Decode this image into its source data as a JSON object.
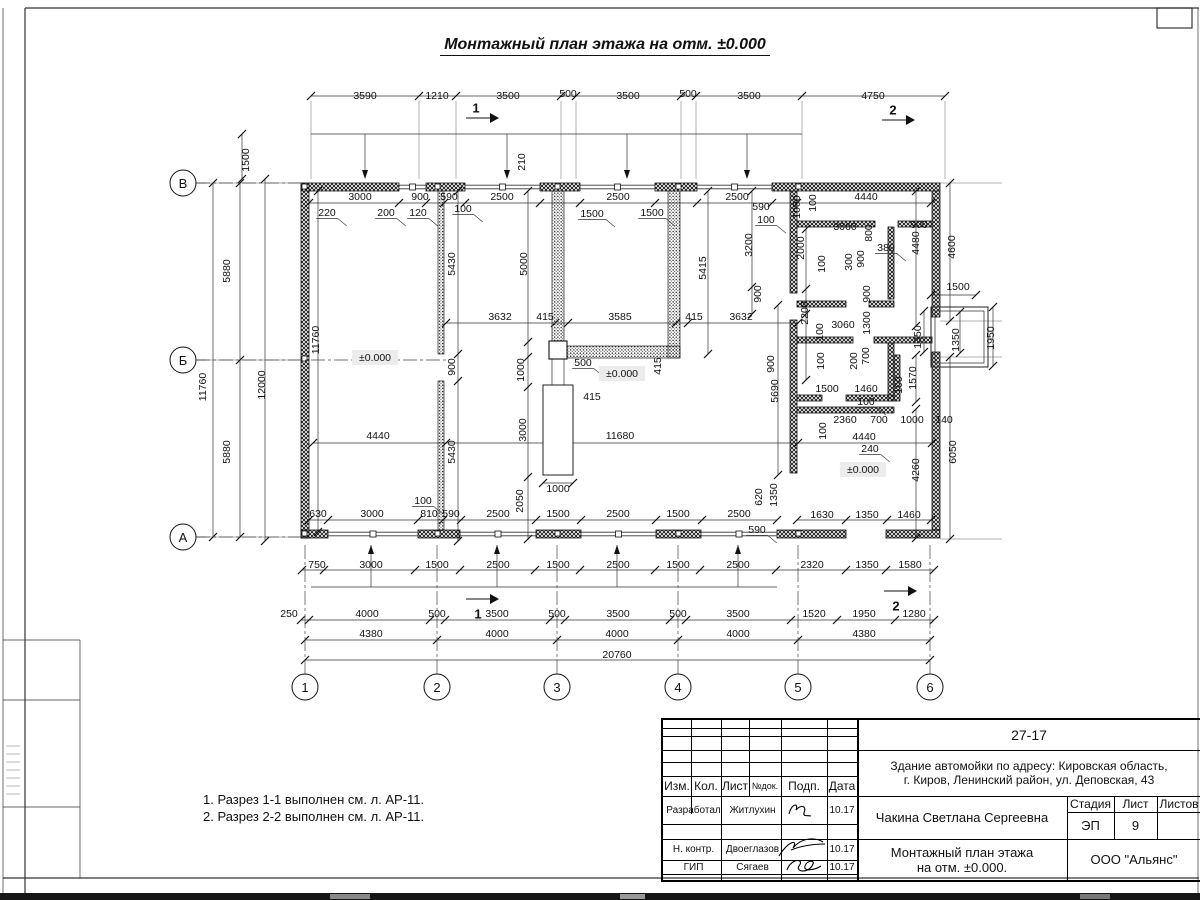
{
  "sheet": {
    "main_title": "Монтажный план этажа на отм. ±0.000",
    "notes": [
      "1. Разрез 1-1 выполнен см. л. АР-11.",
      "2. Разрез 2-2 выполнен см. л. АР-11."
    ]
  },
  "axes": {
    "rows": [
      "В",
      "Б",
      "А"
    ],
    "cols": [
      "1",
      "2",
      "3",
      "4",
      "5",
      "6"
    ]
  },
  "section_marks": {
    "top1": "1",
    "top2": "2",
    "bottom1": "1",
    "bottom2": "2"
  },
  "elevation_mark": "±0.000",
  "dim_labels": [
    {
      "t": "3590",
      "x": 365,
      "y": 96
    },
    {
      "t": "1210",
      "x": 437,
      "y": 96
    },
    {
      "t": "3500",
      "x": 508,
      "y": 96
    },
    {
      "t": "500",
      "x": 568,
      "y": 94
    },
    {
      "t": "3500",
      "x": 628,
      "y": 96
    },
    {
      "t": "500",
      "x": 688,
      "y": 94
    },
    {
      "t": "3500",
      "x": 749,
      "y": 96
    },
    {
      "t": "4750",
      "x": 873,
      "y": 96
    },
    {
      "t": "1500",
      "x": 246,
      "y": 160,
      "f": "r"
    },
    {
      "t": "210",
      "x": 522,
      "y": 162,
      "f": "r"
    },
    {
      "t": "3000",
      "x": 360,
      "y": 197
    },
    {
      "t": "900",
      "x": 420,
      "y": 197
    },
    {
      "t": "590",
      "x": 449,
      "y": 197
    },
    {
      "t": "2500",
      "x": 502,
      "y": 197
    },
    {
      "t": "2500",
      "x": 618,
      "y": 197
    },
    {
      "t": "2500",
      "x": 737,
      "y": 197
    },
    {
      "t": "4440",
      "x": 866,
      "y": 197
    },
    {
      "t": "590",
      "x": 761,
      "y": 207
    },
    {
      "t": "100",
      "x": 766,
      "y": 220,
      "f": "u"
    },
    {
      "t": "220",
      "x": 327,
      "y": 213,
      "f": "u"
    },
    {
      "t": "200",
      "x": 386,
      "y": 213,
      "f": "u"
    },
    {
      "t": "120",
      "x": 418,
      "y": 213,
      "f": "u"
    },
    {
      "t": "100",
      "x": 463,
      "y": 209,
      "f": "u"
    },
    {
      "t": "1500",
      "x": 592,
      "y": 214,
      "f": "u"
    },
    {
      "t": "1500",
      "x": 652,
      "y": 213,
      "f": "u"
    },
    {
      "t": "1000",
      "x": 797,
      "y": 207,
      "f": "r"
    },
    {
      "t": "100",
      "x": 813,
      "y": 203,
      "f": "r"
    },
    {
      "t": "5880",
      "x": 227,
      "y": 271,
      "f": "r"
    },
    {
      "t": "11760",
      "x": 203,
      "y": 387,
      "f": "r"
    },
    {
      "t": "12000",
      "x": 262,
      "y": 385,
      "f": "r"
    },
    {
      "t": "5880",
      "x": 227,
      "y": 452,
      "f": "r"
    },
    {
      "t": "11760",
      "x": 316,
      "y": 340,
      "f": "r"
    },
    {
      "t": "5430",
      "x": 452,
      "y": 264,
      "f": "r"
    },
    {
      "t": "5000",
      "x": 524,
      "y": 264,
      "f": "r"
    },
    {
      "t": "5415",
      "x": 703,
      "y": 268,
      "f": "r"
    },
    {
      "t": "900",
      "x": 452,
      "y": 367,
      "f": "r"
    },
    {
      "t": "5430",
      "x": 452,
      "y": 452,
      "f": "r"
    },
    {
      "t": "3632",
      "x": 500,
      "y": 317
    },
    {
      "t": "415",
      "x": 545,
      "y": 317
    },
    {
      "t": "3585",
      "x": 620,
      "y": 317
    },
    {
      "t": "415",
      "x": 694,
      "y": 317
    },
    {
      "t": "3632",
      "x": 741,
      "y": 317
    },
    {
      "t": "500",
      "x": 583,
      "y": 363,
      "f": "u"
    },
    {
      "t": "415",
      "x": 592,
      "y": 397
    },
    {
      "t": "415",
      "x": 658,
      "y": 366,
      "f": "r"
    },
    {
      "t": "1000",
      "x": 521,
      "y": 370,
      "f": "r"
    },
    {
      "t": "3000",
      "x": 523,
      "y": 430,
      "f": "r"
    },
    {
      "t": "2050",
      "x": 520,
      "y": 501,
      "f": "r"
    },
    {
      "t": "1000",
      "x": 558,
      "y": 489
    },
    {
      "t": "4440",
      "x": 378,
      "y": 436
    },
    {
      "t": "11680",
      "x": 620,
      "y": 436
    },
    {
      "t": "±0.000",
      "x": 375,
      "y": 358,
      "f": "b"
    },
    {
      "t": "±0.000",
      "x": 622,
      "y": 374,
      "f": "b"
    },
    {
      "t": "±0.000",
      "x": 863,
      "y": 470,
      "f": "b"
    },
    {
      "t": "4600",
      "x": 952,
      "y": 247,
      "f": "r"
    },
    {
      "t": "4480",
      "x": 916,
      "y": 243,
      "f": "r"
    },
    {
      "t": "900",
      "x": 919,
      "y": 225
    },
    {
      "t": "3060",
      "x": 845,
      "y": 227
    },
    {
      "t": "800",
      "x": 869,
      "y": 233,
      "f": "r"
    },
    {
      "t": "380",
      "x": 886,
      "y": 248,
      "f": "u"
    },
    {
      "t": "2000",
      "x": 801,
      "y": 248,
      "f": "r"
    },
    {
      "t": "300",
      "x": 849,
      "y": 262,
      "f": "r"
    },
    {
      "t": "900",
      "x": 861,
      "y": 259,
      "f": "r"
    },
    {
      "t": "100",
      "x": 822,
      "y": 264,
      "f": "r"
    },
    {
      "t": "3200",
      "x": 749,
      "y": 245,
      "f": "r"
    },
    {
      "t": "900",
      "x": 758,
      "y": 294,
      "f": "r"
    },
    {
      "t": "2200",
      "x": 805,
      "y": 313,
      "f": "r"
    },
    {
      "t": "900",
      "x": 867,
      "y": 294,
      "f": "r"
    },
    {
      "t": "3060",
      "x": 843,
      "y": 325
    },
    {
      "t": "1300",
      "x": 867,
      "y": 323,
      "f": "r"
    },
    {
      "t": "100",
      "x": 820,
      "y": 332,
      "f": "r"
    },
    {
      "t": "1500",
      "x": 958,
      "y": 287
    },
    {
      "t": "1350",
      "x": 918,
      "y": 337,
      "f": "r"
    },
    {
      "t": "1350",
      "x": 956,
      "y": 340,
      "f": "r"
    },
    {
      "t": "1950",
      "x": 991,
      "y": 338,
      "f": "r"
    },
    {
      "t": "5690",
      "x": 775,
      "y": 391,
      "f": "r"
    },
    {
      "t": "900",
      "x": 771,
      "y": 364,
      "f": "r"
    },
    {
      "t": "100",
      "x": 821,
      "y": 361,
      "f": "r"
    },
    {
      "t": "200",
      "x": 854,
      "y": 361,
      "f": "r"
    },
    {
      "t": "700",
      "x": 866,
      "y": 356,
      "f": "r"
    },
    {
      "t": "1500",
      "x": 827,
      "y": 389
    },
    {
      "t": "1460",
      "x": 866,
      "y": 389
    },
    {
      "t": "100",
      "x": 866,
      "y": 402,
      "f": "u"
    },
    {
      "t": "100",
      "x": 899,
      "y": 385,
      "f": "r"
    },
    {
      "t": "1570",
      "x": 913,
      "y": 378,
      "f": "r"
    },
    {
      "t": "2360",
      "x": 845,
      "y": 420
    },
    {
      "t": "700",
      "x": 879,
      "y": 420
    },
    {
      "t": "1000",
      "x": 912,
      "y": 420
    },
    {
      "t": "140",
      "x": 944,
      "y": 420
    },
    {
      "t": "100",
      "x": 823,
      "y": 431,
      "f": "r"
    },
    {
      "t": "4440",
      "x": 864,
      "y": 437
    },
    {
      "t": "240",
      "x": 870,
      "y": 449,
      "f": "u"
    },
    {
      "t": "4260",
      "x": 916,
      "y": 470,
      "f": "r"
    },
    {
      "t": "6050",
      "x": 953,
      "y": 452,
      "f": "r"
    },
    {
      "t": "630",
      "x": 318,
      "y": 514
    },
    {
      "t": "3000",
      "x": 372,
      "y": 514
    },
    {
      "t": "100",
      "x": 423,
      "y": 501,
      "f": "u"
    },
    {
      "t": "810",
      "x": 429,
      "y": 514
    },
    {
      "t": "590",
      "x": 451,
      "y": 514
    },
    {
      "t": "2500",
      "x": 498,
      "y": 514
    },
    {
      "t": "1500",
      "x": 558,
      "y": 514
    },
    {
      "t": "2500",
      "x": 618,
      "y": 514
    },
    {
      "t": "1500",
      "x": 678,
      "y": 514
    },
    {
      "t": "2500",
      "x": 739,
      "y": 514
    },
    {
      "t": "620",
      "x": 759,
      "y": 497,
      "f": "r"
    },
    {
      "t": "1350",
      "x": 774,
      "y": 495,
      "f": "r"
    },
    {
      "t": "590",
      "x": 757,
      "y": 530,
      "f": "u"
    },
    {
      "t": "1630",
      "x": 822,
      "y": 515
    },
    {
      "t": "1350",
      "x": 867,
      "y": 515
    },
    {
      "t": "1460",
      "x": 909,
      "y": 515
    },
    {
      "t": "750",
      "x": 317,
      "y": 565
    },
    {
      "t": "3000",
      "x": 371,
      "y": 565
    },
    {
      "t": "1500",
      "x": 437,
      "y": 565
    },
    {
      "t": "2500",
      "x": 498,
      "y": 565
    },
    {
      "t": "1500",
      "x": 558,
      "y": 565
    },
    {
      "t": "2500",
      "x": 618,
      "y": 565
    },
    {
      "t": "1500",
      "x": 678,
      "y": 565
    },
    {
      "t": "2500",
      "x": 738,
      "y": 565
    },
    {
      "t": "2320",
      "x": 812,
      "y": 565
    },
    {
      "t": "1350",
      "x": 867,
      "y": 565
    },
    {
      "t": "1580",
      "x": 910,
      "y": 565
    },
    {
      "t": "250",
      "x": 289,
      "y": 614
    },
    {
      "t": "4000",
      "x": 367,
      "y": 614
    },
    {
      "t": "500",
      "x": 437,
      "y": 614
    },
    {
      "t": "3500",
      "x": 497,
      "y": 614
    },
    {
      "t": "500",
      "x": 557,
      "y": 614
    },
    {
      "t": "3500",
      "x": 618,
      "y": 614
    },
    {
      "t": "500",
      "x": 678,
      "y": 614
    },
    {
      "t": "3500",
      "x": 738,
      "y": 614
    },
    {
      "t": "1520",
      "x": 814,
      "y": 614
    },
    {
      "t": "1950",
      "x": 864,
      "y": 614
    },
    {
      "t": "1280",
      "x": 914,
      "y": 614
    },
    {
      "t": "4380",
      "x": 371,
      "y": 634
    },
    {
      "t": "4000",
      "x": 497,
      "y": 634
    },
    {
      "t": "4000",
      "x": 617,
      "y": 634
    },
    {
      "t": "4000",
      "x": 738,
      "y": 634
    },
    {
      "t": "4380",
      "x": 864,
      "y": 634
    },
    {
      "t": "20760",
      "x": 617,
      "y": 655
    }
  ],
  "title_block": {
    "doc_number": "27-17",
    "address_line1": "Здание автомойки по адресу: Кировская область,",
    "address_line2": "г. Киров, Ленинский район, ул. Деповская, 43",
    "col_izm": "Изм.",
    "col_kol": "Кол.",
    "col_list": "Лист",
    "col_ndok": "№док.",
    "col_podp": "Подп.",
    "col_data": "Дата",
    "signature_rows": [
      {
        "role": "Разработал",
        "name": "Житлухин",
        "date": "10.17"
      },
      {
        "role": "Н. контр.",
        "name": "Двоеглазов",
        "date": "10.17"
      },
      {
        "role": "ГИП",
        "name": "Сягаев",
        "date": "10.17"
      }
    ],
    "project_name": "Чакина Светлана Сергеевна",
    "stage_label": "Стадия",
    "stage": "ЭП",
    "sheet_label": "Лист",
    "sheet": "9",
    "sheets_label": "Листов",
    "drawing_title_line1": "Монтажный план этажа",
    "drawing_title_line2": "на отм. ±0.000.",
    "company": "ООО \"Альянс\""
  }
}
